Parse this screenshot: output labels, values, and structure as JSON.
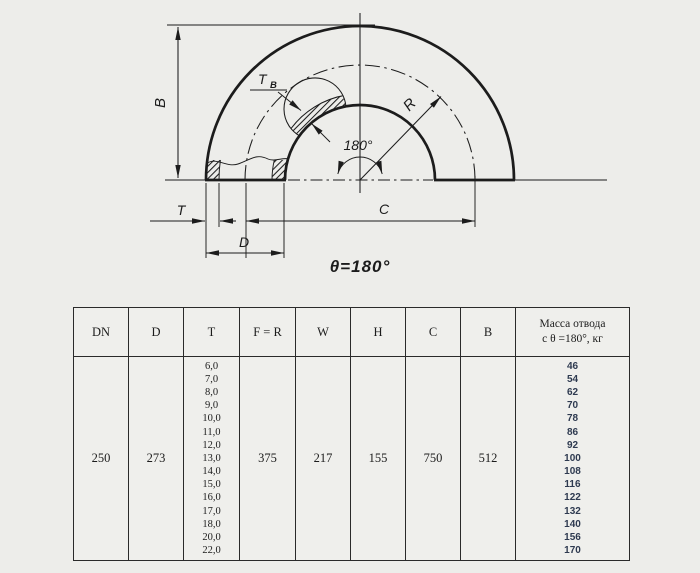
{
  "colors": {
    "ink": "#1c1c1c",
    "mass_text": "#2e3a50",
    "background": "#ededea",
    "table_border": "#2a2a2a"
  },
  "drawing": {
    "labels": {
      "height_b": "B",
      "thickness_t": "T",
      "diameter_d": "D",
      "span_c": "C",
      "radius_r": "R",
      "wall_t_main": "T",
      "wall_t_sub": "В",
      "bend_angle": "180°",
      "theta": "θ=180°"
    }
  },
  "table": {
    "headers": [
      "DN",
      "D",
      "T",
      "F = R",
      "W",
      "H",
      "C",
      "B",
      "Масса отвода\nс θ =180°, кг"
    ],
    "row": {
      "dn": "250",
      "d": "273",
      "t_values": [
        "6,0",
        "7,0",
        "8,0",
        "9,0",
        "10,0",
        "11,0",
        "12,0",
        "13,0",
        "14,0",
        "15,0",
        "16,0",
        "17,0",
        "18,0",
        "20,0",
        "22,0"
      ],
      "f_r": "375",
      "w": "217",
      "h": "155",
      "c": "750",
      "b": "512",
      "mass_values": [
        "46",
        "54",
        "62",
        "70",
        "78",
        "86",
        "92",
        "100",
        "108",
        "116",
        "122",
        "132",
        "140",
        "156",
        "170"
      ]
    }
  }
}
